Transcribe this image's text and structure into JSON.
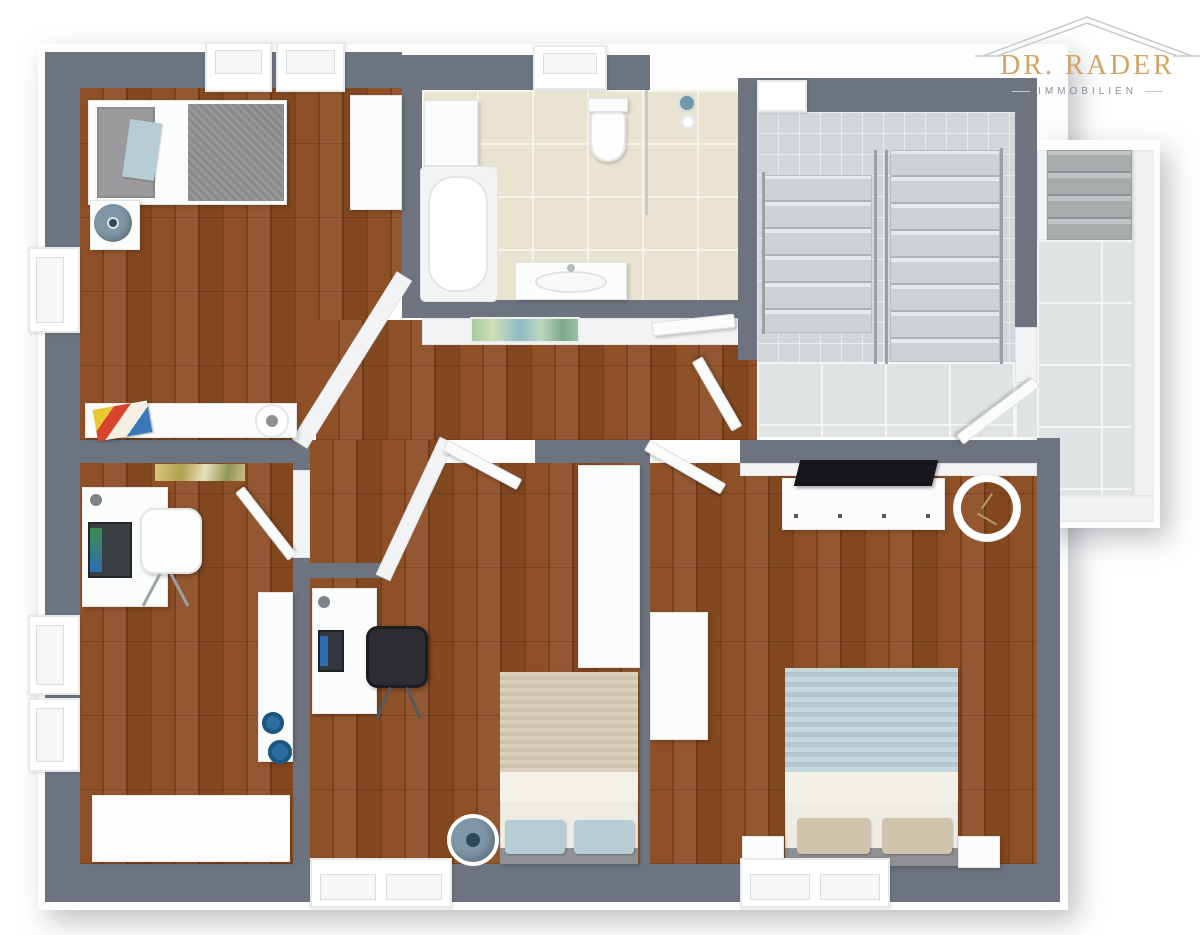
{
  "type": "3d-floor-plan-render",
  "logo": {
    "title": "DR. RADER",
    "subtitle": "IMMOBILIEN"
  },
  "palette": {
    "wall": "#6d7480",
    "wood_a": "#8d5027",
    "wood_b": "#7a421f",
    "wood_c": "#935831",
    "wood_d": "#6f3a1a",
    "wood_e": "#82481f",
    "bath_tile": "#e9e4d2",
    "bath_grout": "#f6f4ea",
    "stair_tile": "#d3d6d8",
    "landing_tile": "#e0e3e4",
    "landing_grout": "#f4f6f6",
    "accent_blue": "#7e96a5",
    "bowl_blue": "#2e6e9e",
    "duvet_gray": "#8f9092",
    "blanket_beige": "#d6cbb4",
    "blanket_blue": "#bcd2d8",
    "pillow_blue": "#b6cdd6",
    "pillow_tan": "#cfc3ab",
    "logo_gold": "#d0a464",
    "logo_gray": "#8a9199",
    "roof_gray": "#c6cacd"
  },
  "rooms": [
    {
      "name": "bedroom-top-left",
      "floor": "wood",
      "furniture": [
        "single-bed",
        "nightstand",
        "table-lamp",
        "wardrobe",
        "sideboard",
        "comic-book",
        "decor-tray"
      ]
    },
    {
      "name": "bathroom",
      "floor": "beige-tile",
      "furniture": [
        "bath-cabinet",
        "bathtub",
        "toilet",
        "shower-glass",
        "shower-head",
        "sink-vanity"
      ]
    },
    {
      "name": "hallway",
      "floor": "wood",
      "furniture": [
        "wall-art"
      ]
    },
    {
      "name": "stairwell",
      "floor": "gray-tile",
      "furniture": [
        "stair-flight-left",
        "stair-flight-right",
        "railing"
      ]
    },
    {
      "name": "landing",
      "floor": "light-tile",
      "furniture": [
        "outdoor-steps",
        "parapet"
      ]
    },
    {
      "name": "office",
      "floor": "wood",
      "furniture": [
        "desk",
        "laptop",
        "desk-lamp",
        "office-chair",
        "storage-bench",
        "blue-bowls",
        "white-rug",
        "wall-art"
      ]
    },
    {
      "name": "bedroom-middle",
      "floor": "wood",
      "furniture": [
        "desk",
        "laptop",
        "desk-lamp",
        "office-chair-black",
        "wardrobe",
        "double-bed",
        "pouf"
      ]
    },
    {
      "name": "bedroom-right",
      "floor": "wood",
      "furniture": [
        "dresser",
        "tv",
        "wall-clock",
        "wardrobe",
        "double-bed",
        "nightstand-left",
        "nightstand-right"
      ]
    }
  ]
}
